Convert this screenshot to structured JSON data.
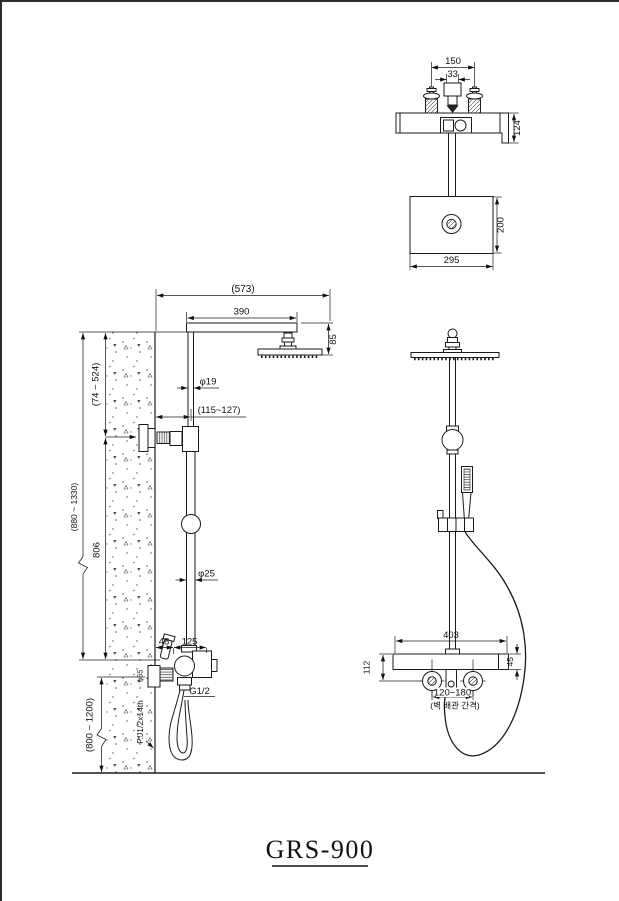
{
  "drawing": {
    "title": "GRS-900",
    "views": {
      "top": {
        "dims": {
          "handle_spacing": "150",
          "spout_width": "33",
          "wall_depth": "124",
          "head_depth": "200",
          "head_width": "295"
        }
      },
      "side": {
        "dims": {
          "overall_reach": "(573)",
          "arm_length": "390",
          "head_drop": "85",
          "upper_pipe_dia": "φ19",
          "wall_to_pipe": "(115~127)",
          "upper_adjust_range": "(74 ~ 524)",
          "overall_height_range": "(880 ~ 1330)",
          "riser_length": "806",
          "lower_pipe_dia": "φ25",
          "wall_offset_a": "48",
          "wall_offset_b": "125",
          "outlet_thread": "G1/2",
          "flange_dia": "φ55",
          "supply_thread": "P.J1/2x14th",
          "install_height_range": "(800 ~ 1200)"
        }
      },
      "front": {
        "dims": {
          "valve_width": "403",
          "valve_center_height": "112",
          "valve_body_height": "45",
          "supply_spacing": "120~180",
          "supply_spacing_note": "(벽 배관 간격)"
        }
      }
    }
  }
}
